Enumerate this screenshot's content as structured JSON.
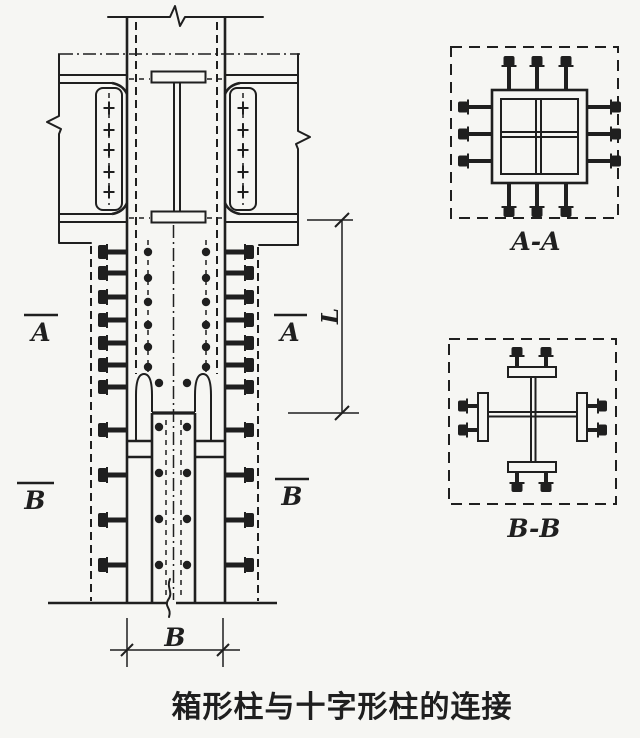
{
  "colors": {
    "ink": "#1f1f1f",
    "paper": "#f6f6f3"
  },
  "caption": "箱形柱与十字形柱的连接",
  "elevation": {
    "marker_a_left": "A",
    "marker_a_right": "A",
    "marker_b_left": "B",
    "marker_b_right": "B",
    "dim_length": "L",
    "dim_width": "B"
  },
  "sections": {
    "aa_label": "A-A",
    "bb_label": "B-B"
  }
}
